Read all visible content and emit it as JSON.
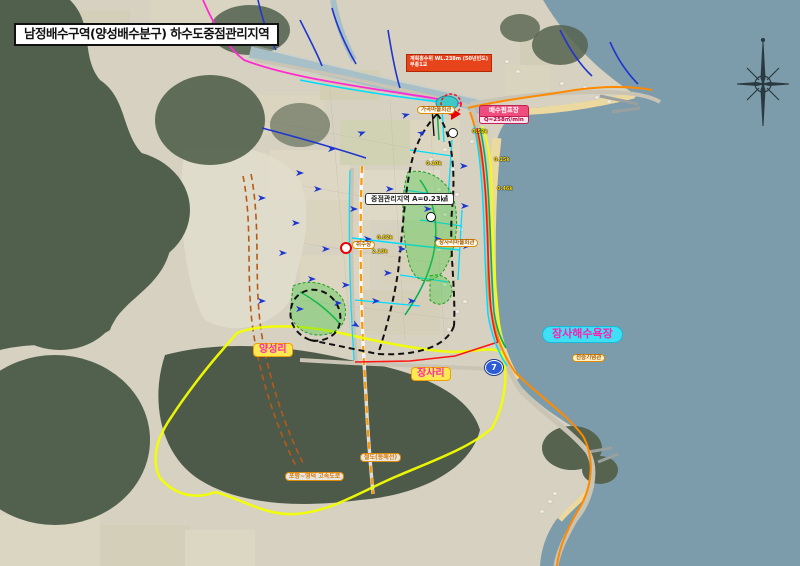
{
  "map": {
    "title": "남정배수구역(양성배수분구) 하수도중점관리지역",
    "annotations": {
      "flood_level_line1": "계획홍수위 WL.238m (50년빈도)",
      "flood_level_line2": "부흥1교",
      "pump_station_name": "배수펌프장",
      "pump_station_capacity": "Q=258㎥/min",
      "priority_area": "중점관리지역 A=0.23㎢",
      "gagok_village_hall": "가곡마을회관",
      "water_intake": "취수장",
      "jangsa_village_hall": "장사리마을회관",
      "jangsa_beach": "장사해수욕장",
      "victory_memorial": "전승기념관",
      "village_yangseong": "양성리",
      "village_jangsa": "장사리",
      "railway": "철도(동해선)",
      "expressway": "포항~영덕 고속도로",
      "route_number": "7"
    },
    "pipe_lengths": [
      "0.52k",
      "0.15k",
      "0.46k",
      "0.62k",
      "2.13k",
      "0.10k"
    ],
    "colors": {
      "sea": "#7d9cab",
      "land": "#d6d1c0",
      "forest": "#51604d",
      "beach_sand": "#ecd9a0",
      "district_boundary_yellow": "#f2ff00",
      "priority_boundary_black": "#111111",
      "sewer_orange": "#ff8a00",
      "sewer_magenta": "#ff2bd0",
      "sewer_cyan": "#00dcff",
      "sewer_blue": "#1f35cf",
      "sewer_green": "#00b054",
      "sewer_red": "#ff1515",
      "railway_orange": "#ff9500",
      "expressway_brown": "#b55a17"
    }
  }
}
